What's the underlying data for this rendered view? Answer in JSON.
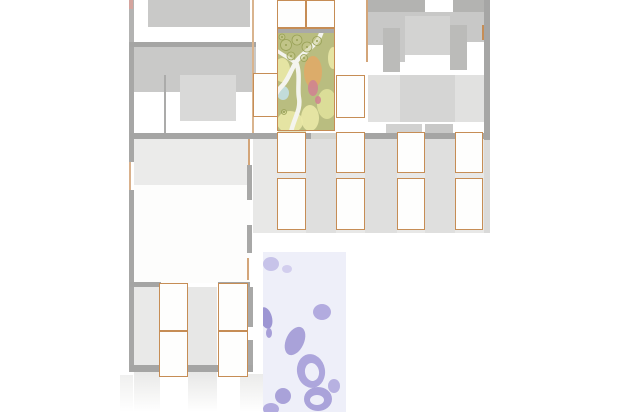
{
  "plan": {
    "canvas": {
      "w": 618,
      "h": 412,
      "bg": "#ffffff"
    },
    "palette": {
      "wall_dark": "#a5a5a4",
      "wall_mid": "#b3b3b2",
      "mass_gray": "#c9c9c8",
      "block_light": "#d9d9d8",
      "band_light": "#e8e8e7",
      "cell_border": "#c68d55",
      "cell_fill": "#fefefd",
      "garden_green": "#b9bd80",
      "garden_yellow": "#eae8a6",
      "garden_orange": "#e0aa67",
      "garden_pink": "#cf8490",
      "garden_blue": "#c3dfe2",
      "water_purple": "#a9a2d9",
      "water_bg": "#eeeff9"
    },
    "regions": [
      {
        "n": "left-wall-top",
        "x": 129,
        "y": 0,
        "w": 5,
        "h": 42,
        "c": "#b3b3b2"
      },
      {
        "n": "left-wall-pink-tick",
        "x": 129,
        "y": 0,
        "w": 4,
        "h": 9,
        "c": "#d4a49e"
      },
      {
        "n": "left-wall-mid",
        "x": 129,
        "y": 42,
        "w": 5,
        "h": 120,
        "c": "#a7a7a6"
      },
      {
        "n": "left-wall-door-gap",
        "x": 129,
        "y": 162,
        "w": 5,
        "h": 28,
        "c": "#ffffff"
      },
      {
        "n": "left-door-line",
        "x": 129,
        "y": 162,
        "w": 2,
        "h": 28,
        "c": "#d9b18c"
      },
      {
        "n": "left-wall-lower",
        "x": 129,
        "y": 190,
        "w": 5,
        "h": 182,
        "c": "#a7a7a6"
      },
      {
        "n": "lb-top-block",
        "x": 148,
        "y": 0,
        "w": 102,
        "h": 27,
        "c": "#c9c9c8"
      },
      {
        "n": "lb-wall-h1",
        "x": 130,
        "y": 42,
        "w": 126,
        "h": 5,
        "c": "#a5a5a4"
      },
      {
        "n": "lb-block-main",
        "x": 134,
        "y": 47,
        "w": 122,
        "h": 45,
        "c": "#c9c9c8"
      },
      {
        "n": "lb-inner-square",
        "x": 180,
        "y": 75,
        "w": 56,
        "h": 46,
        "c": "#d9d9d8"
      },
      {
        "n": "lb-vwall",
        "x": 164,
        "y": 75,
        "w": 2,
        "h": 58,
        "c": "#ababaa"
      },
      {
        "n": "corridor-line-left",
        "x": 252,
        "y": 0,
        "w": 2,
        "h": 133,
        "c": "#d9b48e"
      },
      {
        "n": "rb-orange-line",
        "x": 366,
        "y": 0,
        "w": 2,
        "h": 62,
        "c": "#d3a579"
      },
      {
        "n": "rb-top-dark",
        "x": 368,
        "y": 0,
        "w": 117,
        "h": 12,
        "c": "#b3b3b1"
      },
      {
        "n": "rb-top-notch",
        "x": 425,
        "y": 0,
        "w": 28,
        "h": 12,
        "c": "#ffffff"
      },
      {
        "n": "rb-mass",
        "x": 368,
        "y": 12,
        "w": 117,
        "h": 50,
        "c": "#c8c8c7"
      },
      {
        "n": "rb-inner-light",
        "x": 405,
        "y": 16,
        "w": 45,
        "h": 40,
        "c": "#d3d3d2"
      },
      {
        "n": "rb-white-left",
        "x": 368,
        "y": 45,
        "w": 15,
        "h": 30,
        "c": "#ffffff"
      },
      {
        "n": "rb-white-right",
        "x": 467,
        "y": 42,
        "w": 17,
        "h": 33,
        "c": "#ffffff"
      },
      {
        "n": "rb-white-mid",
        "x": 405,
        "y": 55,
        "w": 45,
        "h": 20,
        "c": "#ffffff"
      },
      {
        "n": "rb-dark-a",
        "x": 383,
        "y": 28,
        "w": 17,
        "h": 44,
        "c": "#bbbbb9"
      },
      {
        "n": "rb-dark-b",
        "x": 450,
        "y": 25,
        "w": 17,
        "h": 45,
        "c": "#bbbbb9"
      },
      {
        "n": "rb-band-light",
        "x": 368,
        "y": 75,
        "w": 117,
        "h": 47,
        "c": "#e1e1e0"
      },
      {
        "n": "rb-band-block",
        "x": 400,
        "y": 75,
        "w": 55,
        "h": 47,
        "c": "#d5d5d4"
      },
      {
        "n": "rb-white-bottom",
        "x": 368,
        "y": 122,
        "w": 117,
        "h": 11,
        "c": "#ffffff"
      },
      {
        "n": "rb-bottom-block-a",
        "x": 386,
        "y": 124,
        "w": 36,
        "h": 9,
        "c": "#d1d1d0"
      },
      {
        "n": "rb-bottom-block-b",
        "x": 425,
        "y": 124,
        "w": 28,
        "h": 9,
        "c": "#c8c8c7"
      },
      {
        "n": "rb-right-wall",
        "x": 484,
        "y": 0,
        "w": 6,
        "h": 140,
        "c": "#a6a6a5"
      },
      {
        "n": "rb-right-wall-light",
        "x": 484,
        "y": 140,
        "w": 6,
        "h": 93,
        "c": "#dadad9"
      },
      {
        "n": "rb-orange-tick",
        "x": 482,
        "y": 25,
        "w": 2,
        "h": 15,
        "c": "#c68d55"
      },
      {
        "n": "mid-band-bg",
        "x": 253,
        "y": 139,
        "w": 231,
        "h": 94,
        "c": "#e8e8e7"
      },
      {
        "n": "mid-strip-1",
        "x": 306,
        "y": 139,
        "w": 30,
        "h": 94,
        "c": "#dfdfde"
      },
      {
        "n": "mid-strip-2",
        "x": 365,
        "y": 139,
        "w": 32,
        "h": 94,
        "c": "#dfdfde"
      },
      {
        "n": "mid-strip-3",
        "x": 425,
        "y": 139,
        "w": 30,
        "h": 94,
        "c": "#dfdfde"
      },
      {
        "n": "wall-h2-left",
        "x": 130,
        "y": 133,
        "w": 181,
        "h": 6,
        "c": "#a5a5a4"
      },
      {
        "n": "wall-h2-gap",
        "x": 311,
        "y": 133,
        "w": 25,
        "h": 6,
        "c": "#d4d4cf"
      },
      {
        "n": "wall-h2-right",
        "x": 336,
        "y": 133,
        "w": 154,
        "h": 6,
        "c": "#a5a5a4"
      },
      {
        "n": "courtyard-fade-south",
        "x": 278,
        "y": 130,
        "w": 28,
        "h": 9,
        "c": "rgba(216,214,162,0.65)"
      },
      {
        "n": "lm-band",
        "x": 134,
        "y": 139,
        "w": 116,
        "h": 46,
        "c": "#ebebea"
      },
      {
        "n": "lm-room",
        "x": 134,
        "y": 185,
        "w": 116,
        "h": 98,
        "c": "#fdfdfc"
      },
      {
        "n": "lm-rwall-a",
        "x": 247,
        "y": 165,
        "w": 5,
        "h": 35,
        "c": "#a8a8a7"
      },
      {
        "n": "lm-rwall-b",
        "x": 247,
        "y": 225,
        "w": 5,
        "h": 28,
        "c": "#a8a8a7"
      },
      {
        "n": "lm-orange-seg",
        "x": 248,
        "y": 139,
        "w": 2,
        "h": 26,
        "c": "#d3a579"
      },
      {
        "n": "lm-orange-seg2",
        "x": 247,
        "y": 258,
        "w": 2,
        "h": 22,
        "c": "#d3a579"
      },
      {
        "n": "ll-stub-a",
        "x": 130,
        "y": 282,
        "w": 31,
        "h": 5,
        "c": "#a5a5a4"
      },
      {
        "n": "ll-stub-b",
        "x": 218,
        "y": 282,
        "w": 32,
        "h": 5,
        "c": "#a5a5a4"
      },
      {
        "n": "ll-strip-left",
        "x": 134,
        "y": 287,
        "w": 25,
        "h": 79,
        "c": "#e9e9e8"
      },
      {
        "n": "ll-strip-mid",
        "x": 188,
        "y": 287,
        "w": 29,
        "h": 79,
        "c": "#e7e7e6"
      },
      {
        "n": "ll-rwall-a",
        "x": 248,
        "y": 287,
        "w": 5,
        "h": 40,
        "c": "#a8a8a7"
      },
      {
        "n": "ll-rwall-b",
        "x": 248,
        "y": 340,
        "w": 5,
        "h": 28,
        "c": "#a8a8a7"
      },
      {
        "n": "ll-wall-bottom",
        "x": 130,
        "y": 365,
        "w": 123,
        "h": 7,
        "c": "#a5a5a4"
      },
      {
        "n": "fade-strip-left-outer",
        "x": 120,
        "y": 375,
        "w": 13,
        "h": 37,
        "c": "#f0f0ef",
        "fade": true
      },
      {
        "n": "fade-strip-a",
        "x": 134,
        "y": 372,
        "w": 26,
        "h": 40,
        "c": "#e9e9e8",
        "fade": true
      },
      {
        "n": "fade-strip-b",
        "x": 188,
        "y": 372,
        "w": 29,
        "h": 40,
        "c": "#e7e7e6",
        "fade": true
      },
      {
        "n": "fade-strip-c",
        "x": 240,
        "y": 374,
        "w": 24,
        "h": 38,
        "c": "#ebebea",
        "fade": true
      }
    ],
    "cells": [
      {
        "n": "cell-top-court-a",
        "x": 277,
        "y": 0,
        "w": 29,
        "h": 28
      },
      {
        "n": "cell-top-court-b",
        "x": 306,
        "y": 0,
        "w": 29,
        "h": 28
      },
      {
        "n": "cell-corridor-left",
        "x": 253,
        "y": 73,
        "w": 25,
        "h": 44
      },
      {
        "n": "cell-corridor-right",
        "x": 336,
        "y": 75,
        "w": 29,
        "h": 43
      },
      {
        "n": "cell-mid-a1",
        "x": 277,
        "y": 132,
        "w": 29,
        "h": 41
      },
      {
        "n": "cell-mid-b1",
        "x": 336,
        "y": 132,
        "w": 29,
        "h": 41
      },
      {
        "n": "cell-mid-c1",
        "x": 397,
        "y": 132,
        "w": 28,
        "h": 41
      },
      {
        "n": "cell-mid-d1",
        "x": 455,
        "y": 132,
        "w": 28,
        "h": 41
      },
      {
        "n": "cell-mid-a2",
        "x": 277,
        "y": 178,
        "w": 29,
        "h": 52
      },
      {
        "n": "cell-mid-b2",
        "x": 336,
        "y": 178,
        "w": 29,
        "h": 52
      },
      {
        "n": "cell-mid-c2",
        "x": 397,
        "y": 178,
        "w": 28,
        "h": 52
      },
      {
        "n": "cell-mid-d2",
        "x": 455,
        "y": 178,
        "w": 28,
        "h": 52
      },
      {
        "n": "cell-ll-a1",
        "x": 159,
        "y": 283,
        "w": 29,
        "h": 48
      },
      {
        "n": "cell-ll-a2",
        "x": 159,
        "y": 331,
        "w": 29,
        "h": 46
      },
      {
        "n": "cell-ll-b1",
        "x": 218,
        "y": 283,
        "w": 30,
        "h": 48
      },
      {
        "n": "cell-ll-b2",
        "x": 218,
        "y": 331,
        "w": 30,
        "h": 46
      }
    ],
    "courtyard": {
      "x": 277,
      "y": 28,
      "w": 58,
      "h": 103,
      "base": "#b9bd80",
      "wall": {
        "h": 5,
        "c": "#a9a9a8"
      },
      "border": "#c68d55",
      "patches": [
        {
          "cx": 282,
          "cy": 70,
          "rx": 8,
          "ry": 12,
          "c": "#eae8a6"
        },
        {
          "cx": 290,
          "cy": 122,
          "rx": 13,
          "ry": 11,
          "c": "#eae8a6"
        },
        {
          "cx": 327,
          "cy": 104,
          "rx": 10,
          "ry": 15,
          "c": "#dfe09a"
        },
        {
          "cx": 333,
          "cy": 58,
          "rx": 5,
          "ry": 11,
          "c": "#eae8a6"
        },
        {
          "cx": 310,
          "cy": 118,
          "rx": 9,
          "ry": 13,
          "c": "#eae8a6"
        },
        {
          "cx": 313,
          "cy": 72,
          "rx": 9,
          "ry": 16,
          "c": "#e0aa67"
        },
        {
          "cx": 313,
          "cy": 88,
          "rx": 5,
          "ry": 8,
          "c": "#cf8490"
        },
        {
          "cx": 318,
          "cy": 100,
          "rx": 3,
          "ry": 4,
          "c": "#cf8490"
        },
        {
          "cx": 283,
          "cy": 93,
          "rx": 6,
          "ry": 7,
          "c": "#c3dfe2"
        }
      ],
      "path_color": "#f4f4ee",
      "paths": [
        {
          "d": "M322,30 C319,46 302,52 296,62 C290,72 288,80 282,86 C278,90 277,92 276,94",
          "w": 4.5
        },
        {
          "d": "M276,50 C284,56 292,59 296,64",
          "w": 3.5
        },
        {
          "d": "M296,62 C301,74 297,88 299,98 C301,110 294,118 291,132",
          "w": 4.5
        }
      ],
      "tree_stroke": "#98a156",
      "tree_fill": "#c9cc90",
      "trees": [
        {
          "cx": 286,
          "cy": 45,
          "r": 5.5
        },
        {
          "cx": 297,
          "cy": 40,
          "r": 5
        },
        {
          "cx": 307,
          "cy": 47,
          "r": 5
        },
        {
          "cx": 317,
          "cy": 41,
          "r": 4.5
        },
        {
          "cx": 291,
          "cy": 56,
          "r": 4
        },
        {
          "cx": 304,
          "cy": 58,
          "r": 3.5
        },
        {
          "cx": 282,
          "cy": 37,
          "r": 3
        },
        {
          "cx": 284,
          "cy": 112,
          "r": 2.5
        }
      ]
    },
    "water": {
      "x": 263,
      "y": 252,
      "w": 83,
      "h": 160,
      "base": "#eeeff9",
      "blobs": [
        {
          "cx": 271,
          "cy": 264,
          "rx": 8,
          "ry": 7,
          "rot": 0,
          "c": "#c7c3e9"
        },
        {
          "cx": 287,
          "cy": 269,
          "rx": 5,
          "ry": 4,
          "rot": 0,
          "c": "#d2ceee"
        },
        {
          "cx": 266,
          "cy": 318,
          "rx": 6,
          "ry": 11,
          "rot": -15,
          "c": "#9d96d3"
        },
        {
          "cx": 269,
          "cy": 333,
          "rx": 3,
          "ry": 5,
          "rot": 0,
          "c": "#a79fd8"
        },
        {
          "cx": 322,
          "cy": 312,
          "rx": 9,
          "ry": 8,
          "rot": 0,
          "c": "#b2abdf"
        },
        {
          "cx": 295,
          "cy": 341,
          "rx": 9,
          "ry": 15,
          "rot": 25,
          "c": "#a9a2d9"
        },
        {
          "cx": 311,
          "cy": 371,
          "rx": 14,
          "ry": 17,
          "rot": -10,
          "c": "#ada6dc"
        },
        {
          "cx": 283,
          "cy": 396,
          "rx": 8,
          "ry": 8,
          "rot": 0,
          "c": "#a9a2d9"
        },
        {
          "cx": 318,
          "cy": 399,
          "rx": 14,
          "ry": 12,
          "rot": 0,
          "c": "#aaa3da"
        },
        {
          "cx": 334,
          "cy": 386,
          "rx": 6,
          "ry": 7,
          "rot": 0,
          "c": "#b7b1e1"
        },
        {
          "cx": 271,
          "cy": 409,
          "rx": 8,
          "ry": 6,
          "rot": 0,
          "c": "#b2abdf"
        }
      ],
      "holes": [
        {
          "cx": 312,
          "cy": 372,
          "rx": 7,
          "ry": 9,
          "rot": -10
        },
        {
          "cx": 317,
          "cy": 400,
          "rx": 7,
          "ry": 5,
          "rot": 0
        }
      ]
    }
  }
}
